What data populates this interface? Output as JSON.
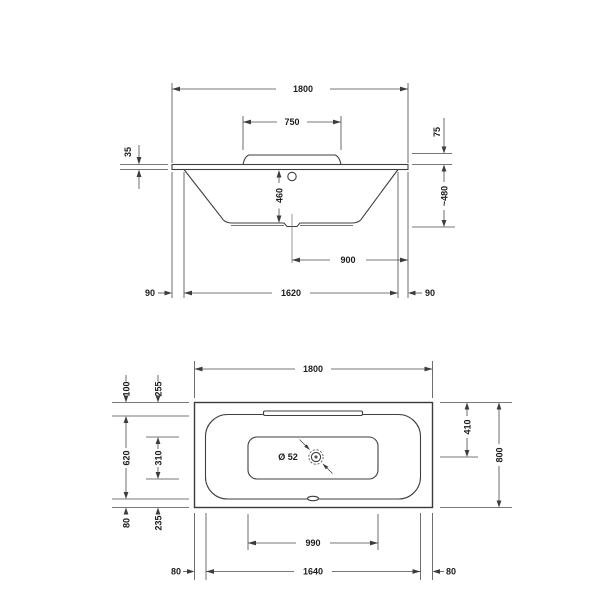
{
  "side_view": {
    "overall_length": "1800",
    "backrest_width": "750",
    "rim_thickness": "35",
    "backrest_height": "75",
    "inner_depth": "460",
    "overall_height": "~480",
    "drain_to_end": "900",
    "overhang_left": "90",
    "base_length": "1620",
    "overhang_right": "90"
  },
  "plan_view": {
    "overall_length": "1800",
    "rim_width_top": "100",
    "floor_inset_top": "255",
    "inner_width": "620",
    "floor_width": "310",
    "rim_width_bottom": "80",
    "floor_inset_bottom": "235",
    "drain_diameter": "Ø 52",
    "drain_from_top": "410",
    "overall_width": "800",
    "floor_length": "990",
    "inner_length": "1640",
    "rim_width_left": "80",
    "rim_width_right": "80"
  },
  "colors": {
    "line": "#4a4a4a",
    "text": "#1c1c1c",
    "background": "#ffffff"
  }
}
